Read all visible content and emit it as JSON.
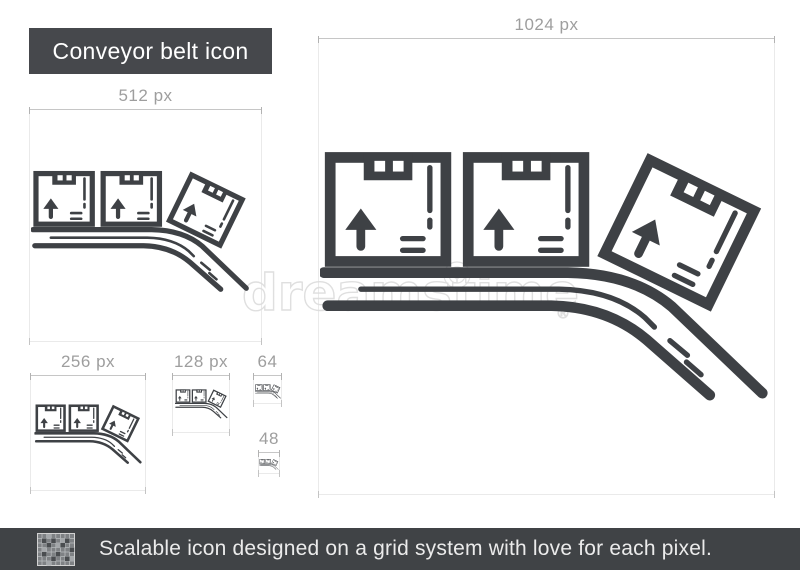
{
  "title": {
    "label": "Conveyor belt icon"
  },
  "artboards": [
    {
      "id": "1024",
      "label": "1024 px"
    },
    {
      "id": "512",
      "label": "512 px"
    },
    {
      "id": "256",
      "label": "256 px"
    },
    {
      "id": "128",
      "label": "128 px"
    },
    {
      "id": "64",
      "label": "64"
    },
    {
      "id": "48",
      "label": "48"
    }
  ],
  "icon": {
    "name": "conveyor-belt-icon",
    "description": "three cardboard boxes with up arrows on a conveyor belt sloping down to the right"
  },
  "watermark": {
    "text": "dreamstime",
    "reg": "®"
  },
  "footer": {
    "caption": "Scalable icon designed on a grid system with love for each pixel."
  },
  "colors": {
    "icon": "#3e4145",
    "title_bg": "#46484c",
    "footer_bg": "#404346",
    "label": "#9e9e9e",
    "artboard_border": "#eaeaea",
    "ruler": "#c6c6c6",
    "watermark": "#dcdcdc"
  }
}
